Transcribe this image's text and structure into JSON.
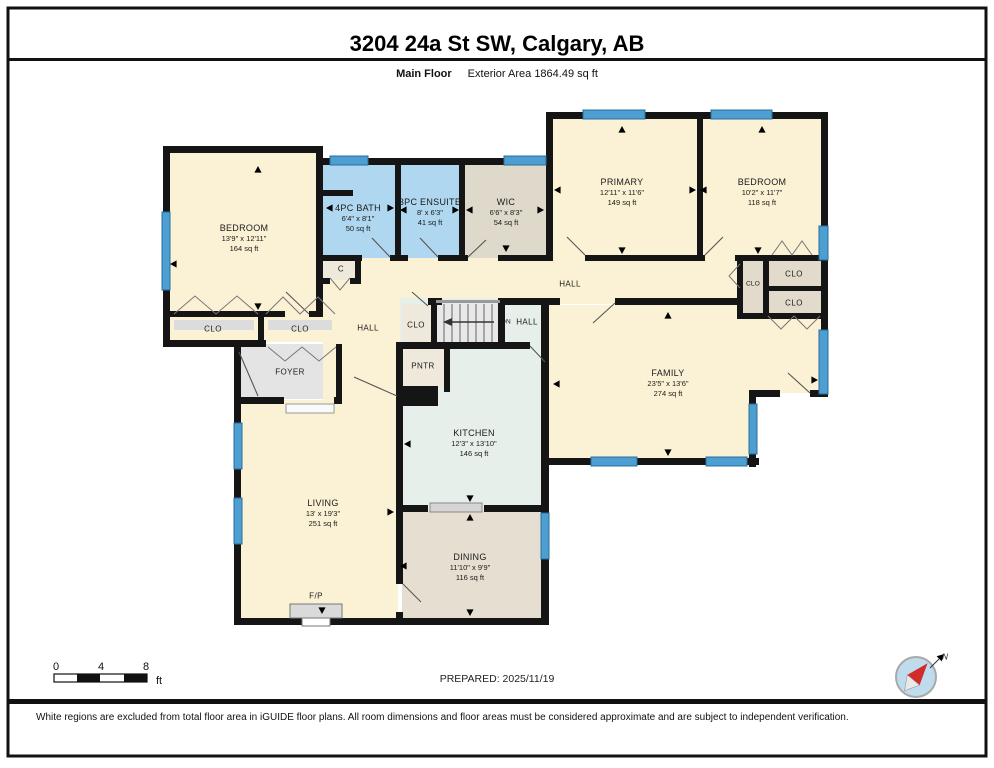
{
  "header": {
    "title": "3204 24a St SW, Calgary, AB",
    "floor_label": "Main Floor",
    "area_label": "Exterior Area 1864.49 sq ft"
  },
  "rooms": {
    "bedroom_left": {
      "name": "BEDROOM",
      "dims": "13'9\" x 12'11\"",
      "area": "164 sq ft"
    },
    "bath_4pc": {
      "name": "4PC BATH",
      "dims": "6'4\" x 8'1\"",
      "area": "50 sq ft"
    },
    "ensuite_3pc": {
      "name": "3PC ENSUITE",
      "dims": "8' x 6'3\"",
      "area": "41 sq ft"
    },
    "wic": {
      "name": "WIC",
      "dims": "6'6\" x 8'3\"",
      "area": "54 sq ft"
    },
    "primary": {
      "name": "PRIMARY",
      "dims": "12'11\" x 11'6\"",
      "area": "149 sq ft"
    },
    "bedroom_right": {
      "name": "BEDROOM",
      "dims": "10'2\" x 11'7\"",
      "area": "118 sq ft"
    },
    "family": {
      "name": "FAMILY",
      "dims": "23'5\" x 13'6\"",
      "area": "274 sq ft"
    },
    "kitchen": {
      "name": "KITCHEN",
      "dims": "12'3\" x 13'10\"",
      "area": "146 sq ft"
    },
    "living": {
      "name": "LIVING",
      "dims": "13' x 19'3\"",
      "area": "251 sq ft"
    },
    "dining": {
      "name": "DINING",
      "dims": "11'10\" x 9'9\"",
      "area": "116 sq ft"
    }
  },
  "labels": {
    "hall": "HALL",
    "clo": "CLO",
    "closet_c": "C",
    "foyer": "FOYER",
    "pantry": "PNTR",
    "fireplace": "F/P",
    "stairs_dn": "DN"
  },
  "scale_bar": {
    "ticks": [
      "0",
      "4",
      "8"
    ],
    "unit": "ft"
  },
  "prepared": "PREPARED: 2025/11/19",
  "compass": {
    "north_label": "N"
  },
  "footer": "White regions are excluded from total floor area in iGUIDE floor plans. All room dimensions and floor areas must be considered approximate and are subject to independent verification.",
  "colors": {
    "wall": "#151515",
    "room_cream": "#FBF2D5",
    "room_blue": "#AFD7F0",
    "room_gray_tan": "#DFD9CB",
    "room_teal": "#E6EFE9",
    "room_tan": "#E6DFD1",
    "foyer_gray": "#E4E4E4",
    "closet_fill": "#EFE9DC",
    "window_blue": "#4C9FD0"
  }
}
